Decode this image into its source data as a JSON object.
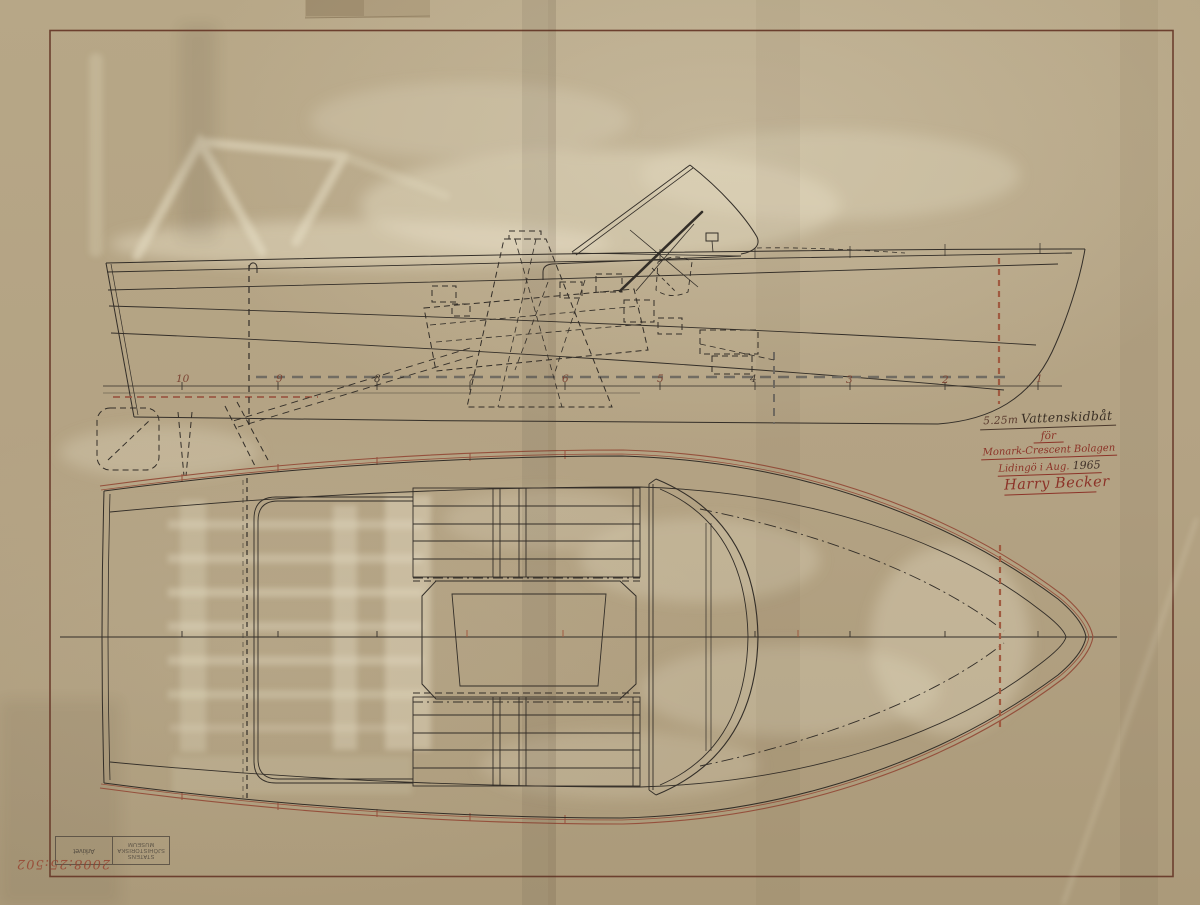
{
  "title_block": {
    "length_label": "5.25m",
    "boat_type": "Vattenskidbåt",
    "for_label": "för",
    "client": "Monark-Crescent Bolagen",
    "place": "Lidingö i Aug.",
    "year": "1965",
    "signature": "Harry Becker"
  },
  "stations": [
    "10",
    "9",
    "8",
    "7",
    "6",
    "5",
    "4",
    "3",
    "2",
    "1"
  ],
  "stamp": {
    "museum_line1": "STATENS",
    "museum_line2": "SJÖHISTORISKA",
    "museum_line3": "MUSEUM",
    "archive_cell": "Arkivet",
    "archive_number": "2008:25:502"
  },
  "colors": {
    "paper": "#b3a283",
    "ink": "#332e28",
    "sepia_line": "#95503c",
    "red_ink": "#8c3328",
    "dash_gray": "#716c62",
    "border": "#6c3f2e"
  }
}
